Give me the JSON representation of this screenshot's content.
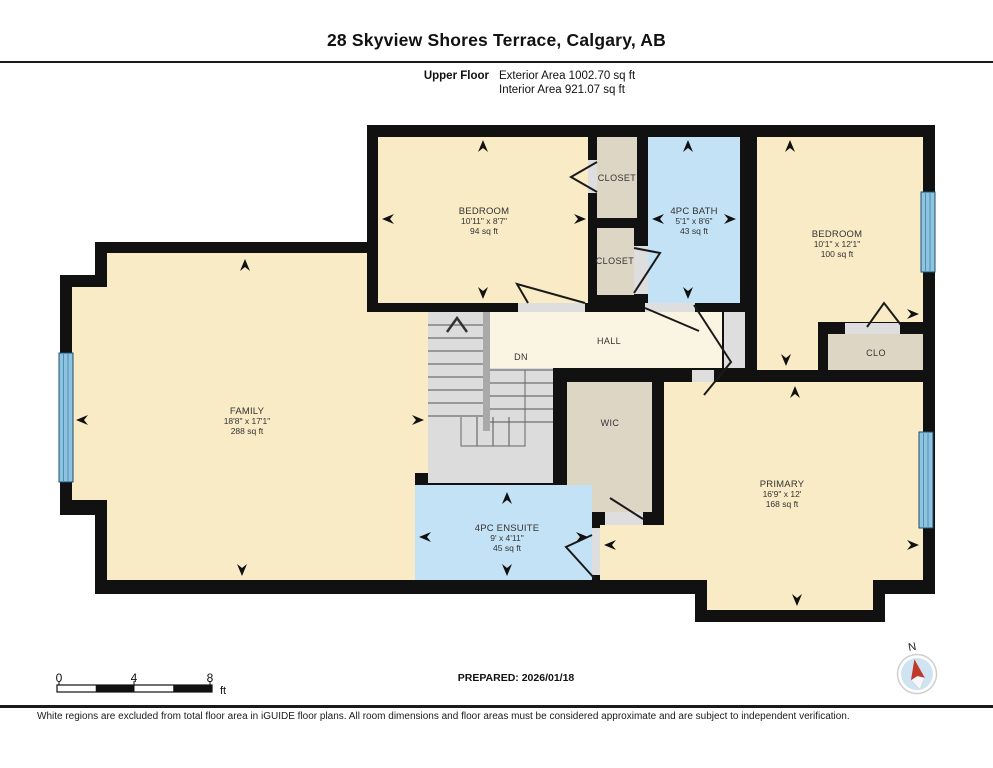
{
  "header": {
    "title": "28 Skyview Shores Terrace, Calgary, AB",
    "floor_label": "Upper Floor",
    "exterior_area": "Exterior Area 1002.70 sq ft",
    "interior_area": "Interior Area 921.07 sq ft"
  },
  "rooms": {
    "bedroom1": {
      "name": "BEDROOM",
      "dims": "10'11\" x 8'7\"",
      "area": "94 sq ft"
    },
    "bath": {
      "name": "4PC BATH",
      "dims": "5'1\" x 8'6\"",
      "area": "43 sq ft"
    },
    "bedroom2": {
      "name": "BEDROOM",
      "dims": "10'1\" x 12'1\"",
      "area": "100 sq ft"
    },
    "family": {
      "name": "FAMILY",
      "dims": "18'8\" x 17'1\"",
      "area": "288 sq ft"
    },
    "primary": {
      "name": "PRIMARY",
      "dims": "16'9\" x 12'",
      "area": "168 sq ft"
    },
    "ensuite": {
      "name": "4PC ENSUITE",
      "dims": "9' x 4'11\"",
      "area": "45 sq ft"
    },
    "closet_upper": {
      "name": "CLOSET"
    },
    "closet_lower": {
      "name": "CLOSET"
    },
    "clo": {
      "name": "CLO"
    },
    "wic": {
      "name": "WIC"
    },
    "hall": {
      "name": "HALL"
    },
    "stairs": {
      "label": "DN"
    }
  },
  "footer": {
    "prepared": "PREPARED: 2026/01/18",
    "disclaimer": "White regions are excluded from total floor area in iGUIDE floor plans. All room dimensions and floor areas must be considered approximate and are subject to independent verification.",
    "scale": {
      "tick0": "0",
      "tick4": "4",
      "tick8": "8",
      "unit": "ft"
    },
    "compass_label": "N"
  },
  "colors": {
    "wall": "#111111",
    "room_tan": "#f8ebc6",
    "hall_cream": "#faf5e2",
    "closet_taupe": "#ded6c5",
    "bath_blue": "#c4e2f5",
    "stair_gray": "#dcdcdc",
    "window_blue": "#8fc3e0",
    "compass_red": "#c0392b"
  }
}
